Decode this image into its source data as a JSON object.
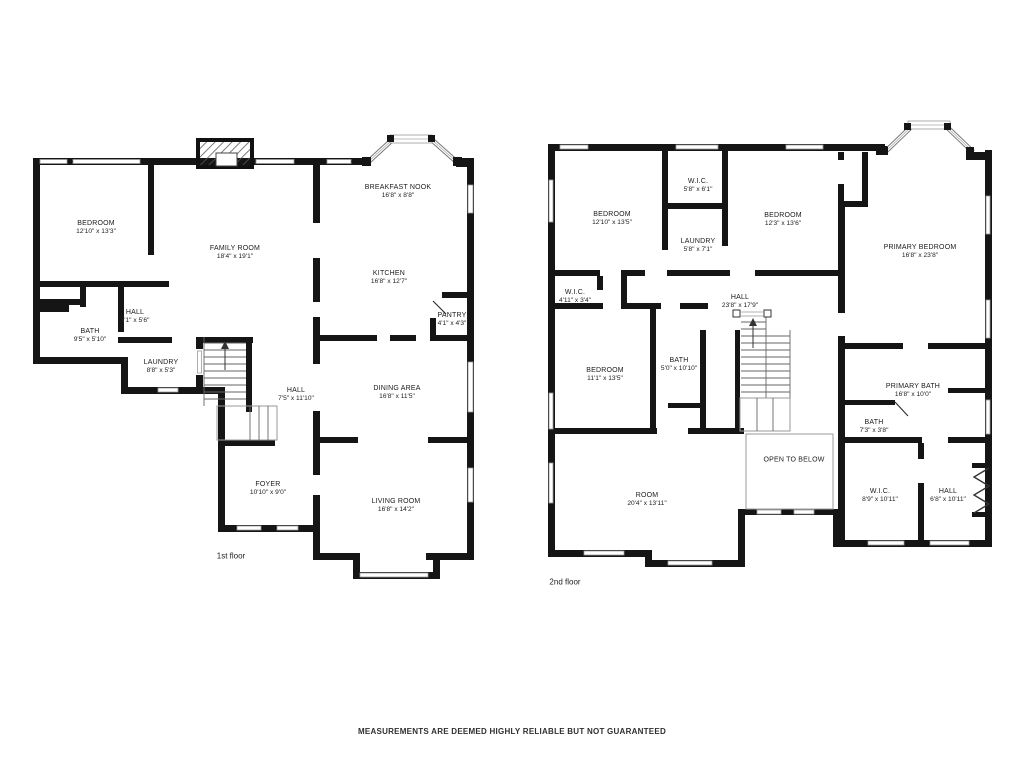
{
  "page": {
    "background": "#ffffff",
    "wall_color": "#151515",
    "footer": "MEASUREMENTS ARE DEEMED HIGHLY RELIABLE BUT NOT GUARANTEED"
  },
  "floor1": {
    "caption": "1st floor",
    "rooms": [
      {
        "name": "BEDROOM",
        "dims": "12'10\" x 13'3\""
      },
      {
        "name": "FAMILY ROOM",
        "dims": "18'4\" x 19'1\""
      },
      {
        "name": "BREAKFAST NOOK",
        "dims": "16'8\" x 8'8\""
      },
      {
        "name": "KITCHEN",
        "dims": "16'8\" x 12'7\""
      },
      {
        "name": "PANTRY",
        "dims": "4'1\" x 4'3\""
      },
      {
        "name": "HALL",
        "dims": "3'1\" x 5'6\""
      },
      {
        "name": "BATH",
        "dims": "9'5\" x 5'10\""
      },
      {
        "name": "LAUNDRY",
        "dims": "8'8\" x 5'3\""
      },
      {
        "name": "HALL",
        "dims": "7'5\" x 11'10\""
      },
      {
        "name": "FOYER",
        "dims": "10'10\" x 9'0\""
      },
      {
        "name": "DINING AREA",
        "dims": "16'8\" x 11'5\""
      },
      {
        "name": "LIVING ROOM",
        "dims": "16'8\" x 14'2\""
      }
    ]
  },
  "floor2": {
    "caption": "2nd floor",
    "rooms": [
      {
        "name": "BEDROOM",
        "dims": "12'10\" x 13'5\""
      },
      {
        "name": "W.I.C.",
        "dims": "5'8\" x 6'1\""
      },
      {
        "name": "LAUNDRY",
        "dims": "5'8\" x 7'1\""
      },
      {
        "name": "BEDROOM",
        "dims": "12'3\" x 13'6\""
      },
      {
        "name": "PRIMARY BEDROOM",
        "dims": "16'8\" x 23'8\""
      },
      {
        "name": "W.I.C.",
        "dims": "4'11\" x 3'4\""
      },
      {
        "name": "HALL",
        "dims": "23'8\" x 17'9\""
      },
      {
        "name": "BEDROOM",
        "dims": "11'1\" x 13'5\""
      },
      {
        "name": "BATH",
        "dims": "5'0\" x 10'10\""
      },
      {
        "name": "PRIMARY BATH",
        "dims": "16'8\" x 10'0\""
      },
      {
        "name": "BATH",
        "dims": "7'3\" x 3'8\""
      },
      {
        "name": "OPEN TO BELOW",
        "dims": ""
      },
      {
        "name": "W.I.C.",
        "dims": "8'9\" x 10'11\""
      },
      {
        "name": "HALL",
        "dims": "6'8\" x 10'11\""
      },
      {
        "name": "ROOM",
        "dims": "20'4\" x 13'11\""
      }
    ]
  }
}
